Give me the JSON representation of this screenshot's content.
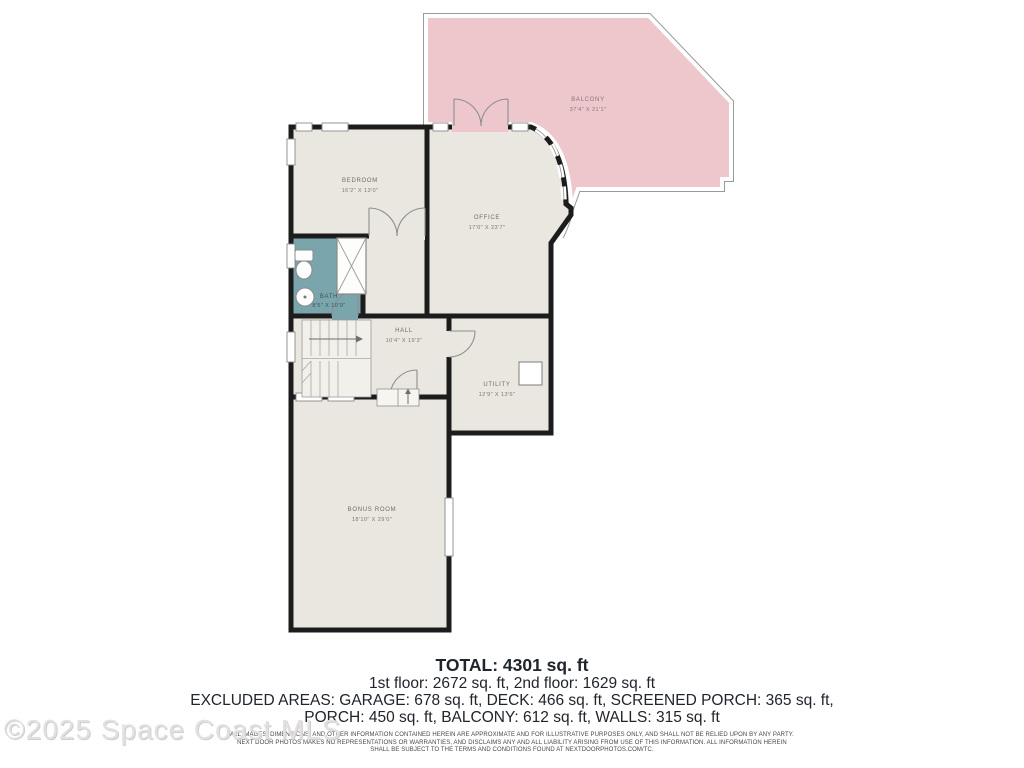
{
  "watermark": "©2025 Space Coast MLS",
  "rooms": [
    {
      "name": "BEDROOM",
      "dims": "16'2\" X 13'0\""
    },
    {
      "name": "OFFICE",
      "dims": "17'0\" X 23'7\""
    },
    {
      "name": "BATH",
      "dims": "8'5\" X 10'0\""
    },
    {
      "name": "HALL",
      "dims": "10'4\" X 19'3\""
    },
    {
      "name": "UTILITY",
      "dims": "12'9\" X 13'6\""
    },
    {
      "name": "BONUS ROOM",
      "dims": "18'10\" X 29'0\""
    },
    {
      "name": "BALCONY",
      "dims": "37'4\" X 21'1\""
    }
  ],
  "summary": {
    "total": "TOTAL: 4301 sq. ft",
    "floors": "1st floor: 2672 sq. ft, 2nd floor: 1629 sq. ft",
    "excluded_line1": "EXCLUDED AREAS: GARAGE: 678 sq. ft, DECK: 466 sq. ft, SCREENED PORCH: 365 sq. ft,",
    "excluded_line2": "PORCH: 450 sq. ft, BALCONY: 612 sq. ft, WALLS: 315 sq. ft"
  },
  "disclaimer": {
    "line1": "ALL IMAGES, DIMENSIONS, AND OTHER INFORMATION CONTAINED HEREIN ARE APPROXIMATE AND FOR ILLUSTRATIVE PURPOSES ONLY, AND SHALL NOT BE RELIED UPON BY ANY PARTY.",
    "line2": "NEXT DOOR PHOTOS MAKES NO REPRESENTATIONS OR WARRANTIES, AND DISCLAIMS ANY AND ALL LIABILITY ARISING FROM USE OF THIS INFORMATION. ALL INFORMATION HEREIN",
    "line3": "SHALL BE SUBJECT TO THE TERMS AND CONDITIONS FOUND AT NEXTDOORPHOTOS.COM/TC."
  },
  "colors": {
    "wall": "#1c1c1c",
    "floor": "#e9e7e0",
    "bath": "#7aa5ad",
    "balcony": "#edc7cb",
    "balcony_outline": "#9a9a9a"
  }
}
